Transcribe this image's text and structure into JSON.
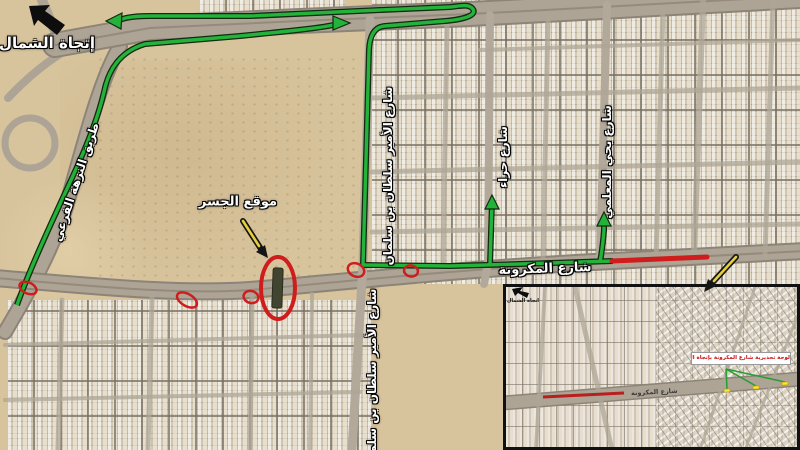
{
  "map": {
    "north_label": "إتجاة الشمال",
    "bridge_site_label": "موقع الجسر",
    "streets": {
      "nuzha_branch": "طريق النزهة الفرعي",
      "prince_sultan": "شارع الأمير سلطان بن سلمان",
      "hira": "شارع حراء",
      "yahya_almuallami": "شارع يحي المعلمي",
      "makarona": "شارع المكرونة"
    },
    "colors": {
      "detour_green": "#23b33a",
      "closure_red": "#cf1d1d",
      "pointer_yellow": "#e6cf3c",
      "marker_yellow": "#ffe23c"
    }
  },
  "inset": {
    "north_label": "اتجاة الشمال",
    "road_label": "شارع المكرونة",
    "warning_label": "لوحة تحذيرية شارع المكرونة بإتجاة الشمال مغلق"
  }
}
